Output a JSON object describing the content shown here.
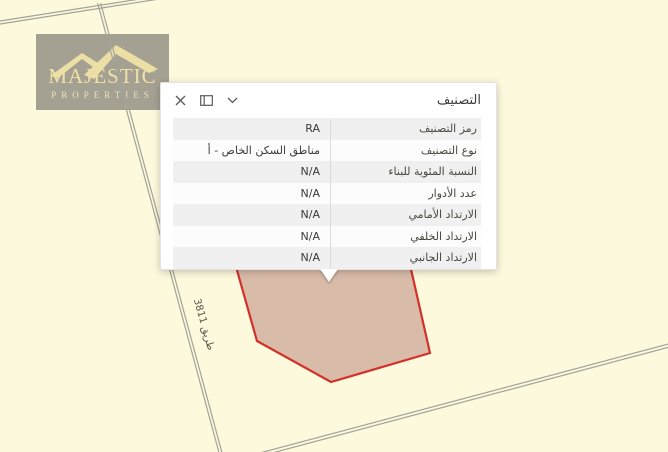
{
  "watermark": {
    "brand": "MAJESTIC",
    "subbrand": "PROPERTIES"
  },
  "map": {
    "road_label": "طريق 3811",
    "colors": {
      "background": "#fcf9dd",
      "road": "#a3a398",
      "parcel_fill": "#d9bba9",
      "parcel_stroke": "#d3302a",
      "logo_bg": "#94928a",
      "logo_text": "#efe1a6"
    }
  },
  "popup": {
    "title": "التصنيف",
    "icon_names": {
      "close": "close-icon",
      "dock": "dock-panel-icon",
      "collapse": "chevron-down-icon"
    },
    "rows": [
      {
        "label": "رمز التصنيف",
        "value": "RA"
      },
      {
        "label": "نوع التصنيف",
        "value": "مناطق السكن الخاص - أ"
      },
      {
        "label": "النسبة المئوية للبناء",
        "value": "N/A"
      },
      {
        "label": "عدد الأدوار",
        "value": "N/A"
      },
      {
        "label": "الارتداد الأمامي",
        "value": "N/A"
      },
      {
        "label": "الارتداد الخلفي",
        "value": "N/A"
      },
      {
        "label": "الارتداد الجانبي",
        "value": "N/A"
      }
    ]
  }
}
